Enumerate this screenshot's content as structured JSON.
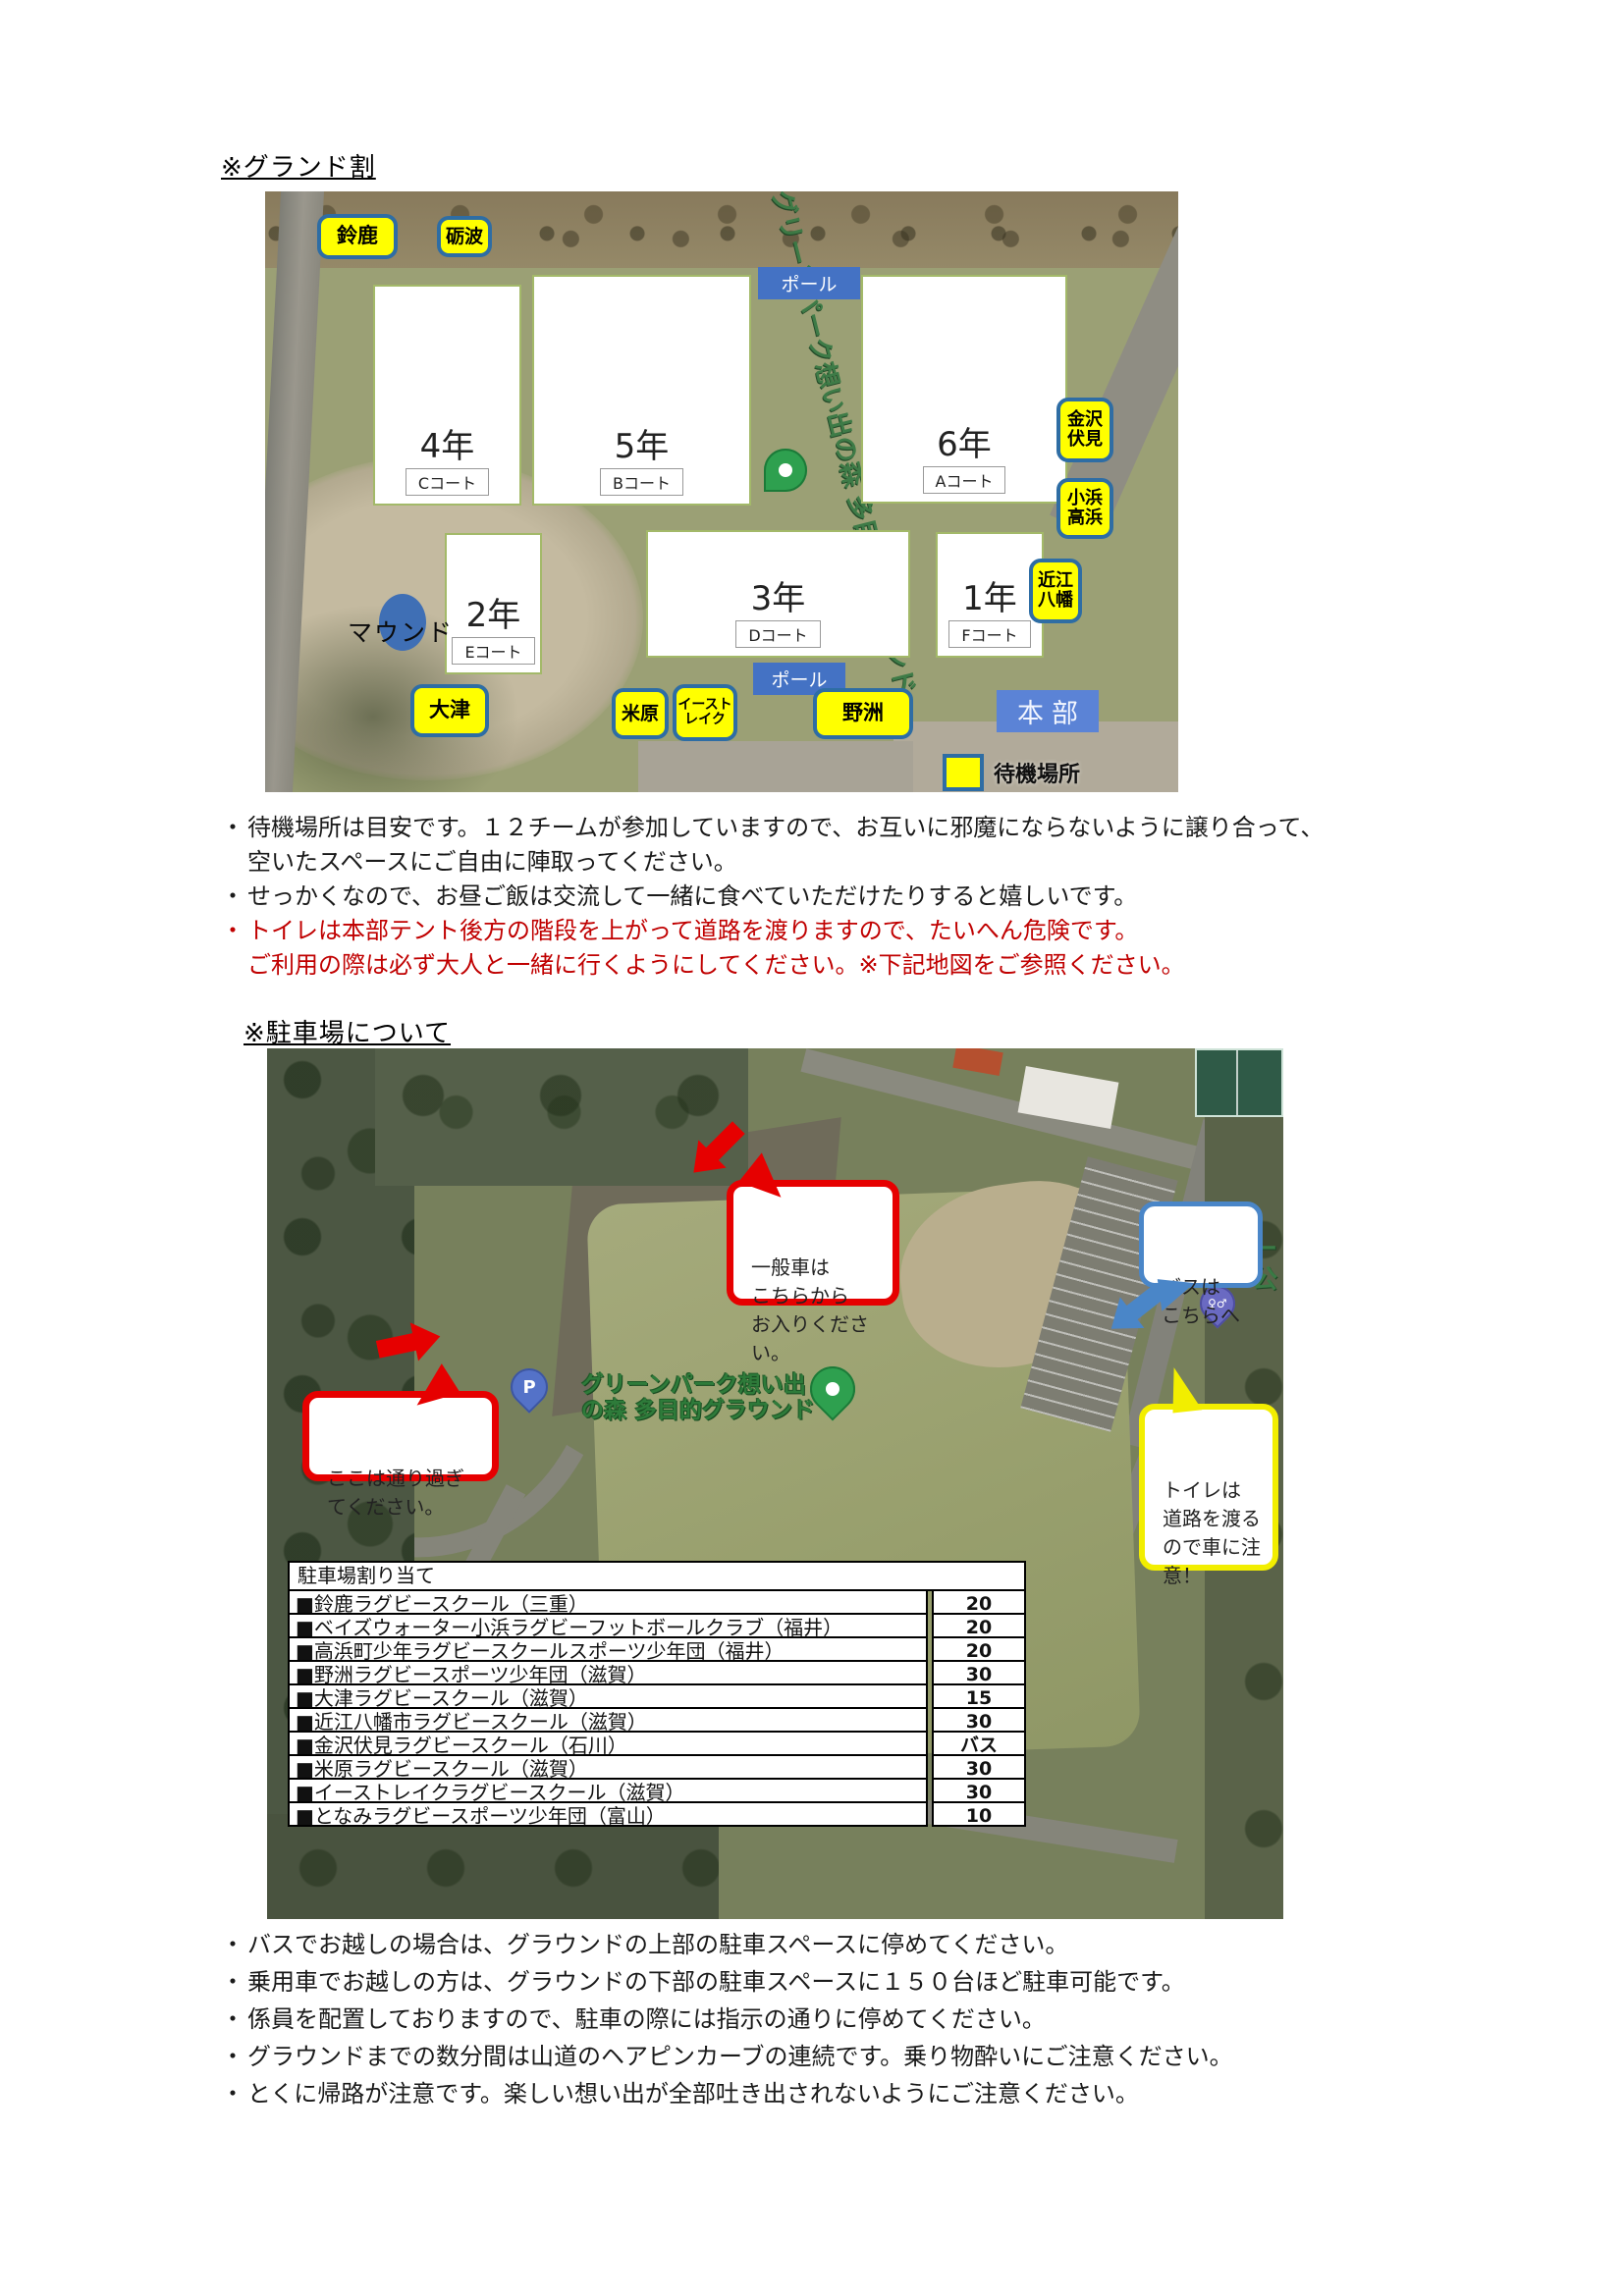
{
  "sections": {
    "ground_title": "※グランド割",
    "parking_title": "※駐車場について"
  },
  "note_bullet": "・",
  "ground_map": {
    "facility_name": "グリーンパーク想い出の森 多目的グラウンド",
    "pole_label": "ポール",
    "hq_label": "本部",
    "mound_label": "マウンド",
    "standby_legend": "待機場所",
    "team_labels": {
      "suzuka": "鈴鹿",
      "tonami": "砺波",
      "kanazawa_fushimi": "金沢\n伏見",
      "obama_takahama": "小浜\n高浜",
      "omi_hachiman": "近江\n八幡",
      "otsu": "大津",
      "maibara": "米原",
      "east_lake": "イースト\nレイク",
      "yasu": "野洲"
    },
    "courts": [
      {
        "grade": "4年",
        "court": "Cコート"
      },
      {
        "grade": "5年",
        "court": "Bコート"
      },
      {
        "grade": "6年",
        "court": "Aコート"
      },
      {
        "grade": "2年",
        "court": "Eコート"
      },
      {
        "grade": "3年",
        "court": "Dコート"
      },
      {
        "grade": "1年",
        "court": "Fコート"
      }
    ]
  },
  "ground_notes": [
    {
      "text": "待機場所は目安です。１２チームが参加していますので、お互いに邪魔にならないように譲り合って、\n空いたスペースにご自由に陣取ってください。"
    },
    {
      "text": "せっかくなので、お昼ご飯は交流して一緒に食べていただけたりすると嬉しいです。"
    },
    {
      "text": "トイレは本部テント後方の階段を上がって道路を渡りますので、たいへん危険です。\nご利用の際は必ず大人と一緒に行くようにしてください。※下記地図をご参照ください。"
    }
  ],
  "parking_map": {
    "facility_name_two_line": "グリーンパーク想い出\nの森 多目的グラウンド",
    "edge_text": "ー\n公",
    "parking_pin_letter": "P",
    "toilet_pin_glyph": "♀♂",
    "bubbles": {
      "general_car": "一般車は\nこちらから\nお入りください。",
      "pass_through": "ここは通り過ぎ\nてください。",
      "bus": "バスは\nこちらへ",
      "toilet": "トイレは\n道路を渡る\nので車に注\n意！"
    },
    "table": {
      "header": "駐車場割り当て",
      "rows": [
        {
          "name": "■鈴鹿ラグビースクール（三重）",
          "count": "20"
        },
        {
          "name": "■ベイズウォーター小浜ラグビーフットボールクラブ（福井）",
          "count": "20"
        },
        {
          "name": "■高浜町少年ラグビースクールスポーツ少年団（福井）",
          "count": "20"
        },
        {
          "name": "■野洲ラグビースポーツ少年団（滋賀）",
          "count": "30"
        },
        {
          "name": "■大津ラグビースクール（滋賀）",
          "count": "15"
        },
        {
          "name": "■近江八幡市ラグビースクール（滋賀）",
          "count": "30"
        },
        {
          "name": "■金沢伏見ラグビースクール（石川）",
          "count": "バス"
        },
        {
          "name": "■米原ラグビースクール（滋賀）",
          "count": "30"
        },
        {
          "name": "■イーストレイクラグビースクール（滋賀）",
          "count": "30"
        },
        {
          "name": "■となみラグビースポーツ少年団（富山）",
          "count": "10"
        }
      ]
    }
  },
  "parking_notes": [
    "バスでお越しの場合は、グラウンドの上部の駐車スペースに停めてください。",
    "乗用車でお越しの方は、グラウンドの下部の駐車スペースに１５０台ほど駐車可能です。",
    "係員を配置しておりますので、駐車の際には指示の通りに停めてください。",
    "グラウンドまでの数分間は山道のヘアピンカーブの連続です。乗り物酔いにご注意ください。",
    "とくに帰路が注意です。楽しい想い出が全部吐き出されないようにご注意ください。"
  ],
  "colors": {
    "team_label_bg": "#ffff00",
    "team_label_border": "#2e6da4",
    "pole_label_bg": "#4472c4",
    "hq_label_bg": "#5b83d6",
    "mound_marker": "#3f6fb5",
    "red_accent": "#e60000",
    "red_note_text": "#c00000",
    "blue_accent": "#4a86c8",
    "yellow_accent": "#f2ee00",
    "green_pin": "#2ea04f",
    "parking_pin": "#5472c8",
    "toilet_pin": "#6a6ac2"
  }
}
